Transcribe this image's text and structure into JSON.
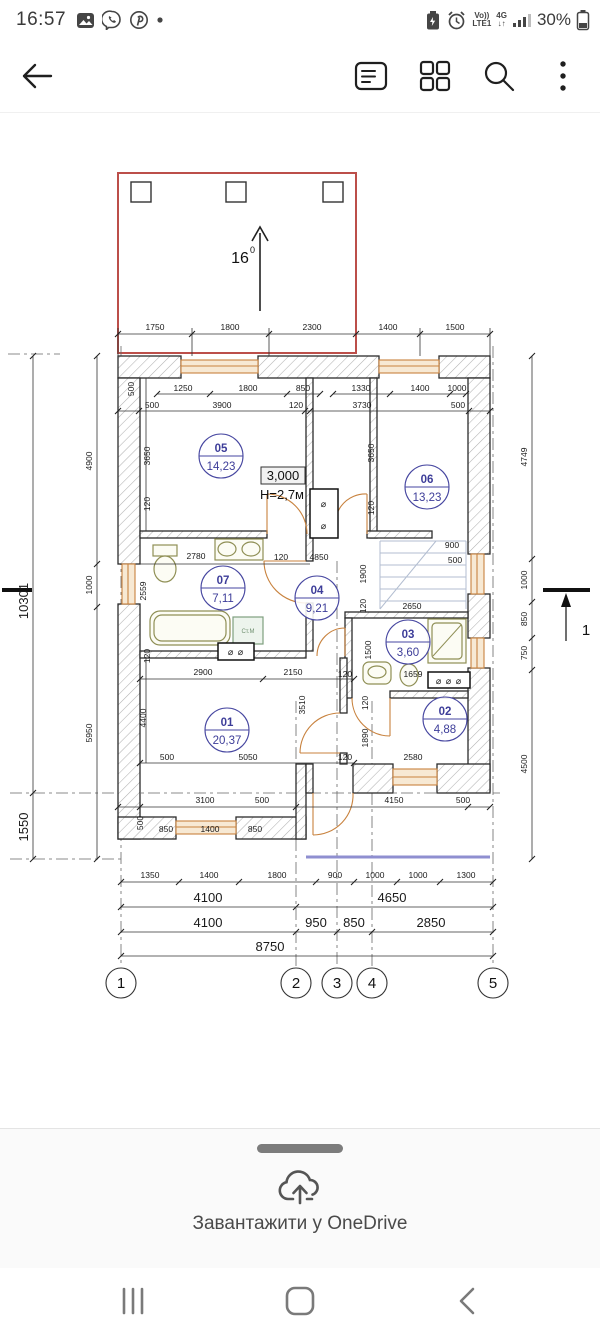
{
  "status_bar": {
    "time": "16:57",
    "volte": "Vo))",
    "lte": "LTE1",
    "net": "4G",
    "battery_pct": "30%"
  },
  "sheet": {
    "action": "Завантажити у OneDrive"
  },
  "plan": {
    "slope": "16",
    "slope_sup": "0",
    "level": "3,000",
    "height": "Н=2,7м",
    "section": "1",
    "washer": "Ст.М",
    "vent_single": "⌀",
    "vent_double": "⌀ ⌀",
    "vent_triple": "⌀ ⌀ ⌀",
    "axes": [
      "1",
      "2",
      "3",
      "4",
      "5"
    ],
    "rooms": [
      {
        "num": "01",
        "area": "20,37"
      },
      {
        "num": "02",
        "area": "4,88"
      },
      {
        "num": "03",
        "area": "3,60"
      },
      {
        "num": "04",
        "area": "9,21"
      },
      {
        "num": "05",
        "area": "14,23"
      },
      {
        "num": "06",
        "area": "13,23"
      },
      {
        "num": "07",
        "area": "7,11"
      }
    ],
    "dims": {
      "top1": [
        "1750",
        "1800",
        "2300",
        "1400",
        "1500"
      ],
      "top2": [
        "1250",
        "1800",
        "850",
        "1330",
        "1400",
        "1000"
      ],
      "top2v": "500",
      "top3": [
        "500",
        "3900",
        "120",
        "3730",
        "500"
      ],
      "left_total": "10301",
      "left": [
        "4900",
        "1000",
        "5950"
      ],
      "left_low": "1550",
      "right": [
        "4749",
        "1000",
        "850",
        "750",
        "4500"
      ],
      "bot1": [
        "1350",
        "1400",
        "1800",
        "900",
        "1000",
        "1000",
        "1300"
      ],
      "bot2": [
        "4100",
        "4650"
      ],
      "bot3": [
        "4100",
        "950",
        "850",
        "2850"
      ],
      "bot_total": "8750",
      "r05": [
        "3650",
        "120"
      ],
      "r06": [
        "3650",
        "120"
      ],
      "bath": [
        "2780",
        "120",
        "4850",
        "2559"
      ],
      "stairs": [
        "900",
        "500",
        "1900",
        "120",
        "2650"
      ],
      "r03": [
        "1500",
        "1659",
        "120"
      ],
      "r02": [
        "120",
        "1890",
        "2580",
        "120"
      ],
      "r01": [
        "120",
        "2900",
        "2150",
        "4400",
        "3510",
        "500",
        "5050"
      ],
      "bot_in": [
        "3100",
        "500",
        "4150",
        "500"
      ],
      "bot_win": [
        "500",
        "850",
        "1400",
        "850"
      ]
    }
  }
}
